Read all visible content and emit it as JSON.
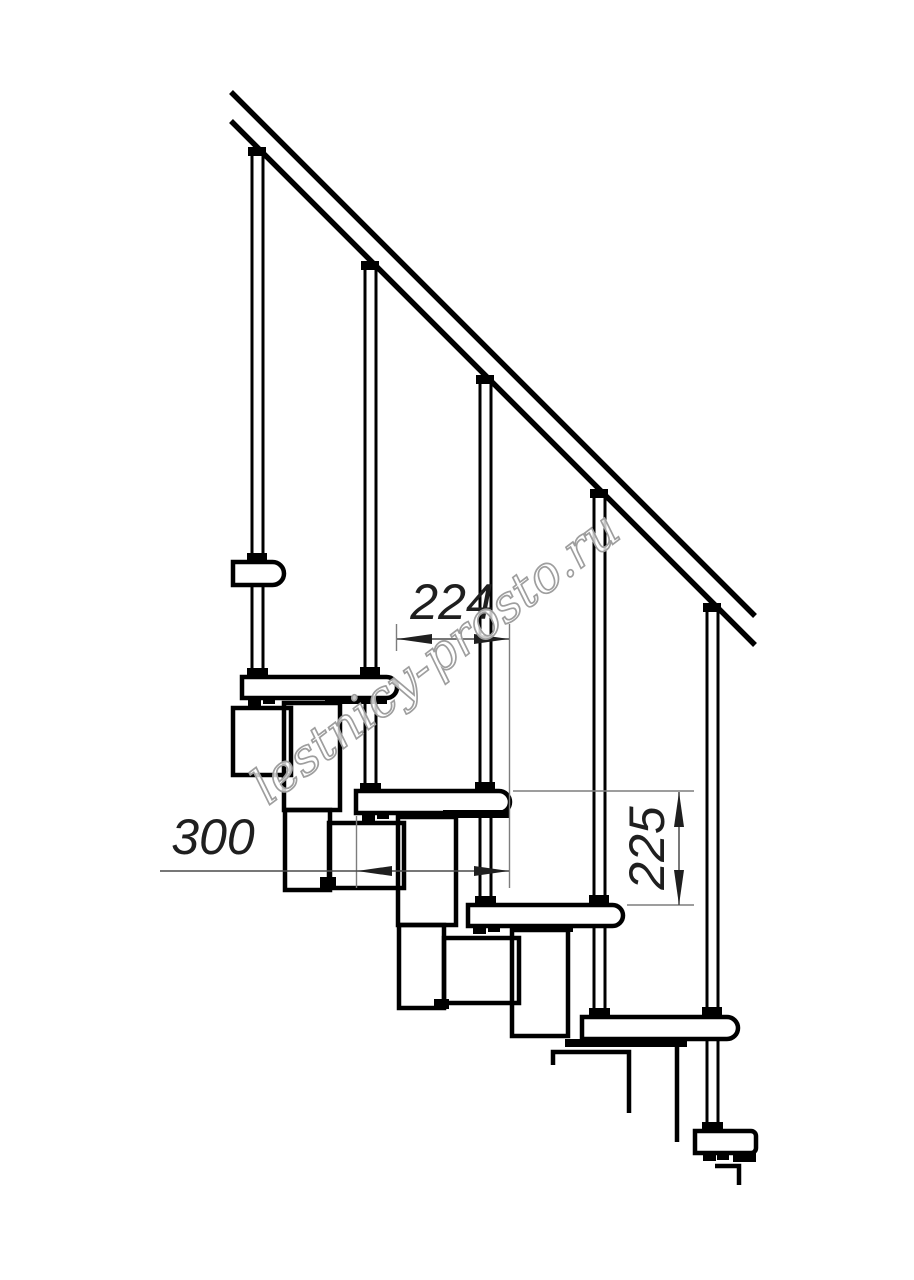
{
  "drawing": {
    "dimensions": {
      "going": "224",
      "tread_depth": "300",
      "rise": "225"
    },
    "watermark": {
      "text": "lestnicy-prosto.ru"
    },
    "colors": {
      "line": "#000000",
      "dimension_line": "#7d7d7d",
      "dimension_text": "#1f1f1f",
      "watermark_outline": "#9e9e9e",
      "background": "#ffffff"
    }
  }
}
